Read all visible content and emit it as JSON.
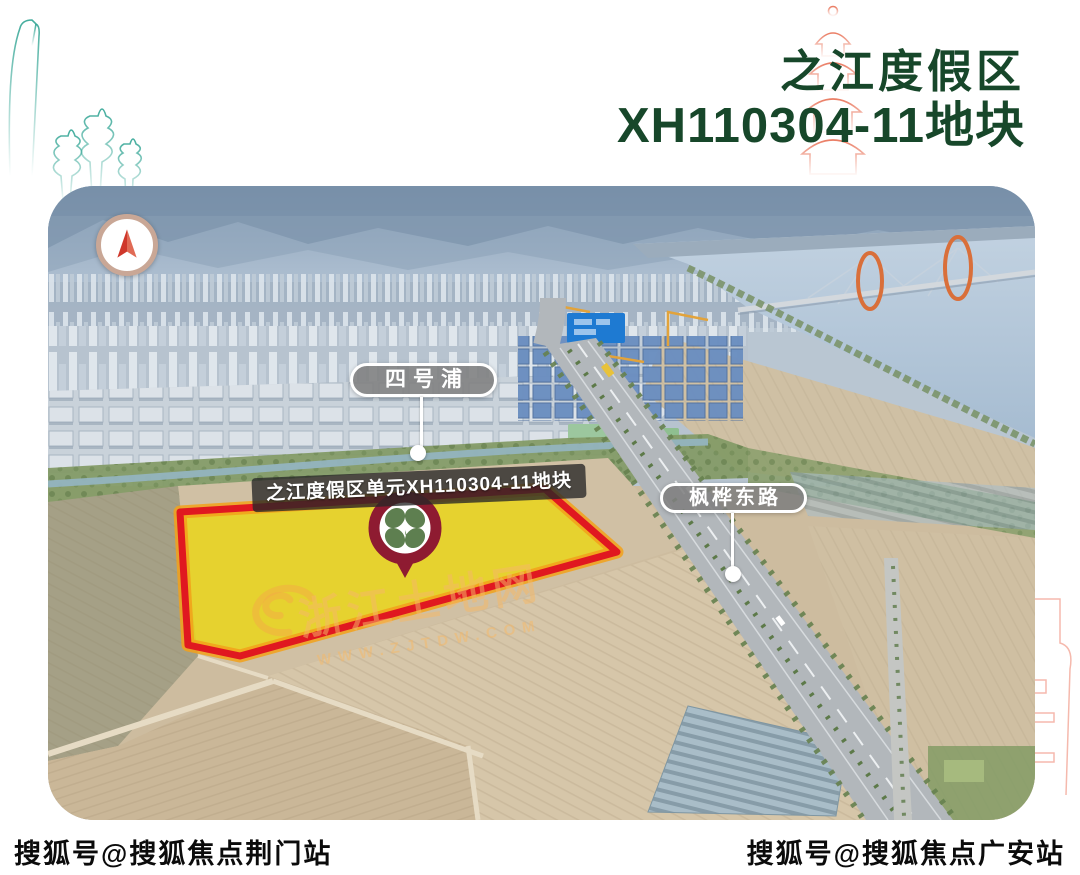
{
  "header": {
    "title_line1": "之江度假区",
    "title_line2": "XH110304-11地块"
  },
  "map": {
    "labels": {
      "canal": "四号浦",
      "road": "枫桦东路",
      "parcel": "之江度假区单元XH110304-11地块"
    },
    "watermark": {
      "line1": "浙江土地网",
      "line2": "WWW.ZJTDW.COM"
    },
    "icons": {
      "compass": "north-arrow-icon",
      "pin": "clover-map-pin-icon"
    }
  },
  "footer": {
    "left": "搜狐号@搜狐焦点荆门站",
    "right": "搜狐号@搜狐焦点广安站"
  },
  "colors": {
    "title_green": "#17472a",
    "parcel_yellow": "#e8d41f",
    "parcel_red": "#e01820",
    "parcel_orange": "#f2a11a",
    "pin_maroon": "#8e1b31",
    "clover_green": "#5e7f50",
    "label_gray": "#808080",
    "watermark_orange": "#f6b868",
    "decor_teal": "#2ea392",
    "decor_salmon": "#ec806a"
  }
}
